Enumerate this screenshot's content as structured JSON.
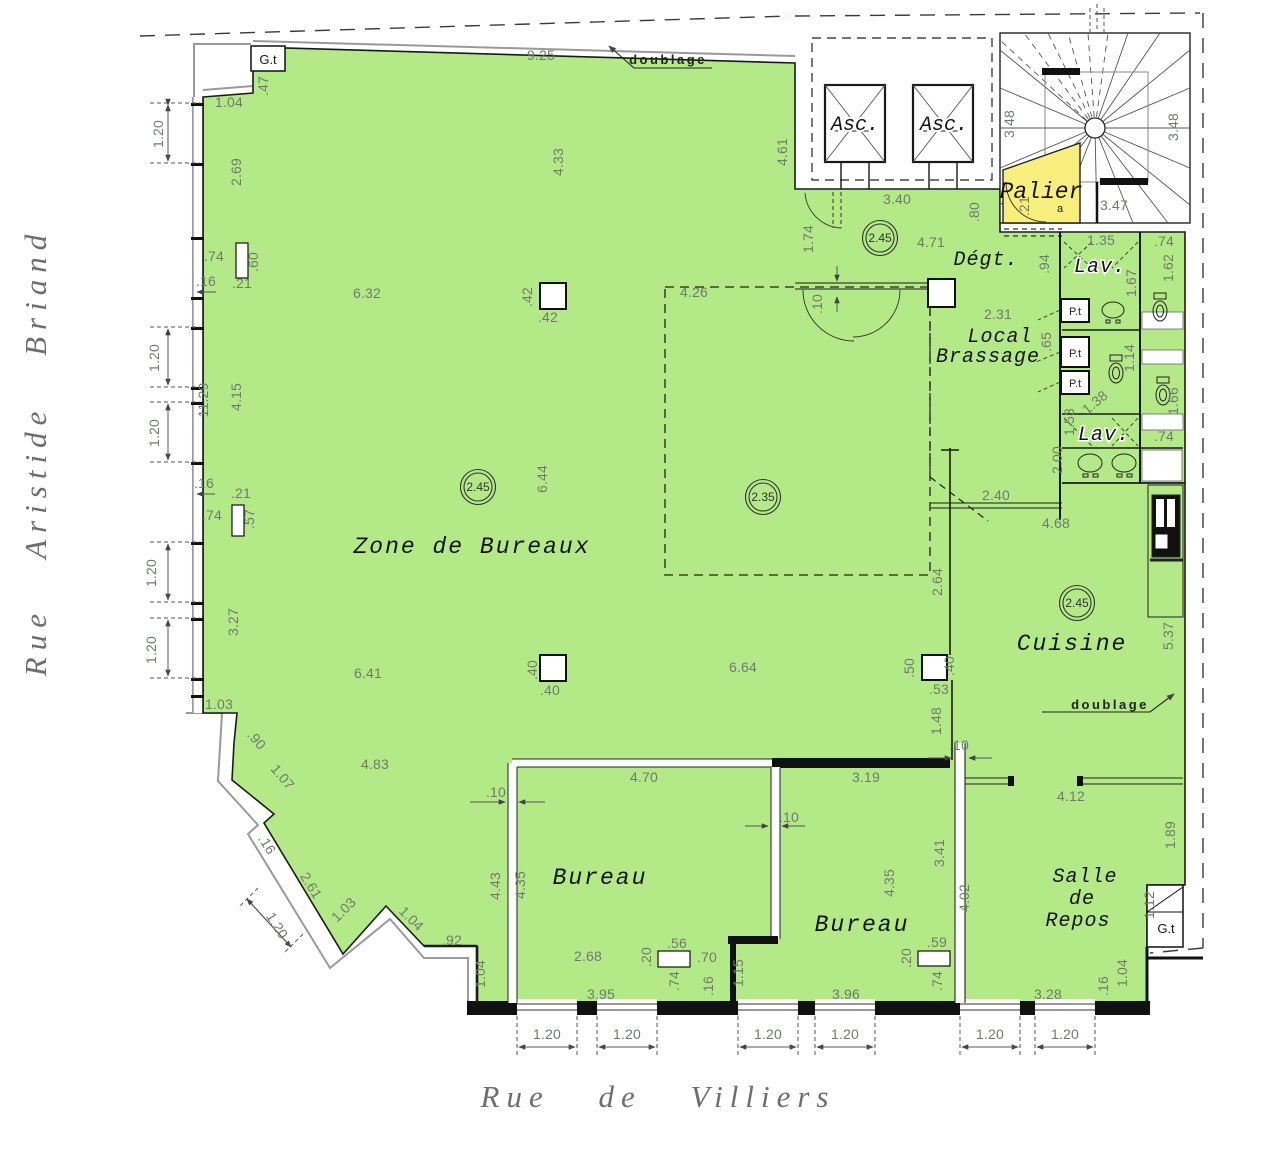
{
  "colors": {
    "floor_green": "#b4e987",
    "palier_yellow": "#f8ee7e",
    "wall_black": "#1a1a1a",
    "dim_gray": "#6f7a6f"
  },
  "streets": {
    "left": "Rue Aristide Briand",
    "bottom": "Rue de Villiers"
  },
  "rooms": {
    "zone": "Zone de Bureaux",
    "bureau1": "Bureau",
    "bureau2": "Bureau",
    "cuisine": "Cuisine",
    "salle_1": "Salle",
    "salle_2": "de",
    "salle_3": "Repos",
    "degt": "Dégt.",
    "local_1": "Local",
    "local_2": "Brassage",
    "lav": "Lav.",
    "palier": "Palier",
    "asc": "Asc.",
    "pt": "P.t",
    "gt": "G.t",
    "doublage": "doublage"
  },
  "level_markers": [
    {
      "x": 478,
      "y": 487,
      "v": "2.45"
    },
    {
      "x": 880,
      "y": 238,
      "v": "2.45"
    },
    {
      "x": 1077,
      "y": 603,
      "v": "2.45"
    },
    {
      "x": 763,
      "y": 497,
      "v": "2.35"
    }
  ],
  "dims": [
    {
      "t": "9.25",
      "x": 541,
      "y": 60
    },
    {
      "t": "1.04",
      "x": 229,
      "y": 107
    },
    {
      "t": "6.32",
      "x": 367,
      "y": 298
    },
    {
      "t": "4.26",
      "x": 694,
      "y": 297
    },
    {
      "t": "3.40",
      "x": 897,
      "y": 204
    },
    {
      "t": "4.71",
      "x": 931,
      "y": 247
    },
    {
      "t": "2.31",
      "x": 998,
      "y": 319
    },
    {
      "t": "1.35",
      "x": 1101,
      "y": 245
    },
    {
      "t": ".74",
      "x": 1164,
      "y": 246
    },
    {
      "t": "3.47",
      "x": 1114,
      "y": 210
    },
    {
      "t": "2.40",
      "x": 996,
      "y": 500
    },
    {
      "t": "4.68",
      "x": 1056,
      "y": 528
    },
    {
      "t": ".74",
      "x": 1164,
      "y": 441
    },
    {
      "t": "6.64",
      "x": 743,
      "y": 672
    },
    {
      "t": "6.41",
      "x": 368,
      "y": 678
    },
    {
      "t": "1.03",
      "x": 219,
      "y": 709
    },
    {
      "t": "4.83",
      "x": 375,
      "y": 769
    },
    {
      "t": "4.70",
      "x": 644,
      "y": 782
    },
    {
      "t": "3.19",
      "x": 866,
      "y": 782
    },
    {
      "t": "4.12",
      "x": 1071,
      "y": 801
    },
    {
      "t": ".53",
      "x": 939,
      "y": 694
    },
    {
      "t": ".92",
      "x": 452,
      "y": 945
    },
    {
      "t": "2.68",
      "x": 588,
      "y": 961
    },
    {
      "t": ".56",
      "x": 677,
      "y": 948
    },
    {
      "t": ".70",
      "x": 707,
      "y": 962
    },
    {
      "t": ".59",
      "x": 937,
      "y": 947
    },
    {
      "t": "3.95",
      "x": 601,
      "y": 999
    },
    {
      "t": "3.96",
      "x": 846,
      "y": 999
    },
    {
      "t": "3.28",
      "x": 1048,
      "y": 999
    },
    {
      "t": "1.20",
      "x": 547,
      "y": 1039
    },
    {
      "t": "1.20",
      "x": 627,
      "y": 1039
    },
    {
      "t": "1.20",
      "x": 768,
      "y": 1039
    },
    {
      "t": "1.20",
      "x": 845,
      "y": 1039
    },
    {
      "t": "1.20",
      "x": 990,
      "y": 1039
    },
    {
      "t": "1.20",
      "x": 1065,
      "y": 1039
    },
    {
      "t": ".10",
      "x": 496,
      "y": 797
    },
    {
      "t": ".10",
      "x": 789,
      "y": 822
    },
    {
      "t": ".10",
      "x": 959,
      "y": 750
    },
    {
      "t": ".16",
      "x": 206,
      "y": 286
    },
    {
      "t": ".21",
      "x": 242,
      "y": 288
    },
    {
      "t": ".74",
      "x": 214,
      "y": 261
    },
    {
      "t": ".16",
      "x": 204,
      "y": 488
    },
    {
      "t": ".21",
      "x": 241,
      "y": 498
    },
    {
      "t": ".74",
      "x": 212,
      "y": 520
    },
    {
      "t": ".42",
      "x": 548,
      "y": 322
    },
    {
      "t": ".40",
      "x": 550,
      "y": 695
    },
    {
      "t": ".47",
      "x": 268,
      "y": 86,
      "r": -90
    },
    {
      "t": "1.20",
      "x": 163,
      "y": 134,
      "r": -90
    },
    {
      "t": "2.69",
      "x": 241,
      "y": 172,
      "r": -90
    },
    {
      "t": "4.33",
      "x": 563,
      "y": 162,
      "r": -90
    },
    {
      "t": "4.61",
      "x": 787,
      "y": 152,
      "r": -90
    },
    {
      "t": "1.74",
      "x": 813,
      "y": 239,
      "r": -90
    },
    {
      "t": ".80",
      "x": 979,
      "y": 212,
      "r": -90
    },
    {
      "t": ".94",
      "x": 1049,
      "y": 264,
      "r": -90
    },
    {
      "t": ".21",
      "x": 1029,
      "y": 206,
      "r": -90
    },
    {
      "t": "3.48",
      "x": 1014,
      "y": 124,
      "r": -90
    },
    {
      "t": "3.48",
      "x": 1178,
      "y": 127,
      "r": -90
    },
    {
      "t": "1.67",
      "x": 1136,
      "y": 283,
      "r": -90
    },
    {
      "t": "1.62",
      "x": 1173,
      "y": 268,
      "r": -90
    },
    {
      "t": ".60",
      "x": 258,
      "y": 262,
      "r": -90
    },
    {
      "t": "11.29",
      "x": 208,
      "y": 400,
      "r": -90
    },
    {
      "t": "4.15",
      "x": 241,
      "y": 397,
      "r": -90
    },
    {
      "t": "1.20",
      "x": 159,
      "y": 358,
      "r": -90
    },
    {
      "t": "1.20",
      "x": 159,
      "y": 433,
      "r": -90
    },
    {
      "t": ".57",
      "x": 254,
      "y": 519,
      "r": -90
    },
    {
      "t": "6.44",
      "x": 547,
      "y": 479,
      "r": -90
    },
    {
      "t": ".42",
      "x": 532,
      "y": 297,
      "r": -90
    },
    {
      "t": "3.27",
      "x": 238,
      "y": 622,
      "r": -90
    },
    {
      "t": "1.20",
      "x": 156,
      "y": 573,
      "r": -90
    },
    {
      "t": "1.20",
      "x": 156,
      "y": 650,
      "r": -90
    },
    {
      "t": ".40",
      "x": 537,
      "y": 670,
      "r": -90
    },
    {
      "t": "2.64",
      "x": 942,
      "y": 582,
      "r": -90
    },
    {
      "t": ".50",
      "x": 914,
      "y": 668,
      "r": -90
    },
    {
      "t": ".40",
      "x": 954,
      "y": 666,
      "r": -90
    },
    {
      "t": "1.48",
      "x": 941,
      "y": 721,
      "r": -90
    },
    {
      "t": "4.43",
      "x": 500,
      "y": 886,
      "r": -90
    },
    {
      "t": "4.35",
      "x": 525,
      "y": 885,
      "r": -90
    },
    {
      "t": "1.15",
      "x": 743,
      "y": 973,
      "r": -90
    },
    {
      "t": ".16",
      "x": 713,
      "y": 986,
      "r": -90
    },
    {
      "t": ".74",
      "x": 679,
      "y": 981,
      "r": -90
    },
    {
      "t": ".20",
      "x": 651,
      "y": 957,
      "r": -90
    },
    {
      "t": ".20",
      "x": 911,
      "y": 958,
      "r": -90
    },
    {
      "t": ".74",
      "x": 942,
      "y": 981,
      "r": -90
    },
    {
      "t": "3.41",
      "x": 944,
      "y": 853,
      "r": -90
    },
    {
      "t": "4.35",
      "x": 894,
      "y": 883,
      "r": -90
    },
    {
      "t": "4.02",
      "x": 969,
      "y": 898,
      "r": -90
    },
    {
      "t": "1.89",
      "x": 1175,
      "y": 835,
      "r": -90
    },
    {
      "t": "5.37",
      "x": 1173,
      "y": 636,
      "r": -90
    },
    {
      "t": "1.12",
      "x": 1154,
      "y": 905,
      "r": -90
    },
    {
      "t": "1.04",
      "x": 485,
      "y": 974,
      "r": -90
    },
    {
      "t": "1.04",
      "x": 1127,
      "y": 973,
      "r": -90
    },
    {
      "t": ".16",
      "x": 1108,
      "y": 986,
      "r": -90
    },
    {
      "t": "2.00",
      "x": 1062,
      "y": 460,
      "r": -90
    },
    {
      "t": "1.53",
      "x": 1074,
      "y": 422,
      "r": -90
    },
    {
      "t": "1.14",
      "x": 1134,
      "y": 358,
      "r": -90
    },
    {
      "t": "1.66",
      "x": 1178,
      "y": 401,
      "r": -90
    },
    {
      "t": ".65",
      "x": 1051,
      "y": 342,
      "r": -90
    },
    {
      "t": ".10",
      "x": 822,
      "y": 304,
      "r": -90
    },
    {
      "t": ".90",
      "x": 253,
      "y": 743,
      "r": 50
    },
    {
      "t": "1.07",
      "x": 279,
      "y": 780,
      "r": 50
    },
    {
      "t": ".16",
      "x": 263,
      "y": 847,
      "r": 58
    },
    {
      "t": "2.61",
      "x": 307,
      "y": 888,
      "r": 58
    },
    {
      "t": "1.20",
      "x": 273,
      "y": 928,
      "r": 58
    },
    {
      "t": "1.03",
      "x": 347,
      "y": 913,
      "r": -45
    },
    {
      "t": "1.04",
      "x": 408,
      "y": 922,
      "r": 45
    },
    {
      "t": "1.38",
      "x": 1098,
      "y": 406,
      "r": -40
    },
    {
      "t": "a",
      "x": 1060,
      "y": 212,
      "k": "tiny"
    }
  ]
}
